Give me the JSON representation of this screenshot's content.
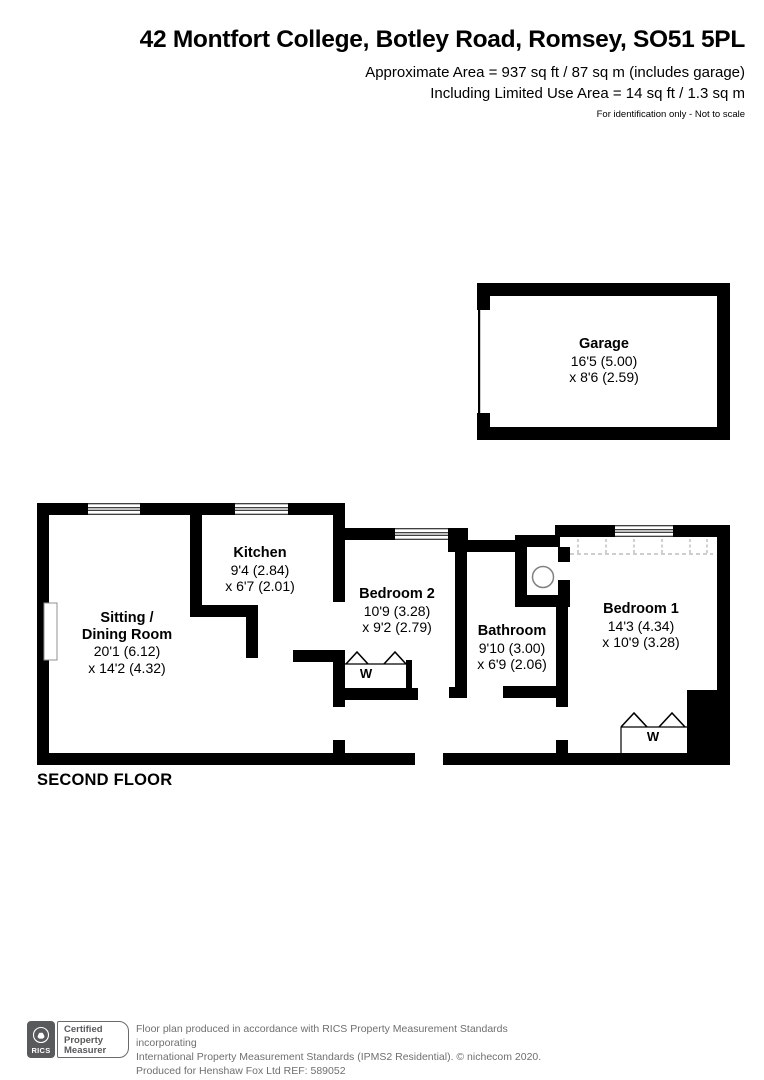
{
  "header": {
    "title": "42 Montfort College, Botley Road, Romsey, SO51 5PL",
    "area_line1": "Approximate Area = 937 sq ft / 87 sq m (includes garage)",
    "area_line2": "Including Limited Use Area = 14 sq ft / 1.3 sq m",
    "disclaimer": "For identification only - Not to scale"
  },
  "floor_label": "SECOND FLOOR",
  "rooms": {
    "garage": {
      "name": "Garage",
      "dim1": "16'5 (5.00)",
      "dim2": "x 8'6 (2.59)"
    },
    "sitting": {
      "name_line1": "Sitting /",
      "name_line2": "Dining Room",
      "dim1": "20'1 (6.12)",
      "dim2": "x 14'2 (4.32)"
    },
    "kitchen": {
      "name": "Kitchen",
      "dim1": "9'4 (2.84)",
      "dim2": "x 6'7 (2.01)"
    },
    "bedroom2": {
      "name": "Bedroom 2",
      "dim1": "10'9 (3.28)",
      "dim2": "x 9'2 (2.79)",
      "wardrobe_label": "W"
    },
    "bathroom": {
      "name": "Bathroom",
      "dim1": "9'10 (3.00)",
      "dim2": "x 6'9 (2.06)"
    },
    "bedroom1": {
      "name": "Bedroom 1",
      "dim1": "14'3 (4.34)",
      "dim2": "x 10'9 (3.28)",
      "wardrobe_label": "W"
    }
  },
  "footer": {
    "rics_label": "RICS",
    "badge_line1": "Certified",
    "badge_line2": "Property",
    "badge_line3": "Measurer",
    "line1": "Floor plan produced in accordance with RICS Property Measurement Standards incorporating",
    "line2": "International Property Measurement Standards (IPMS2 Residential).   © nichecom 2020.",
    "line3": "Produced for Henshaw Fox Ltd   REF: 589052"
  },
  "colors": {
    "wall": "#000000",
    "dashed_limited_use": "#b0b0b0",
    "footer_text": "#6f6f6f",
    "logo_gray": "#595a5c"
  }
}
